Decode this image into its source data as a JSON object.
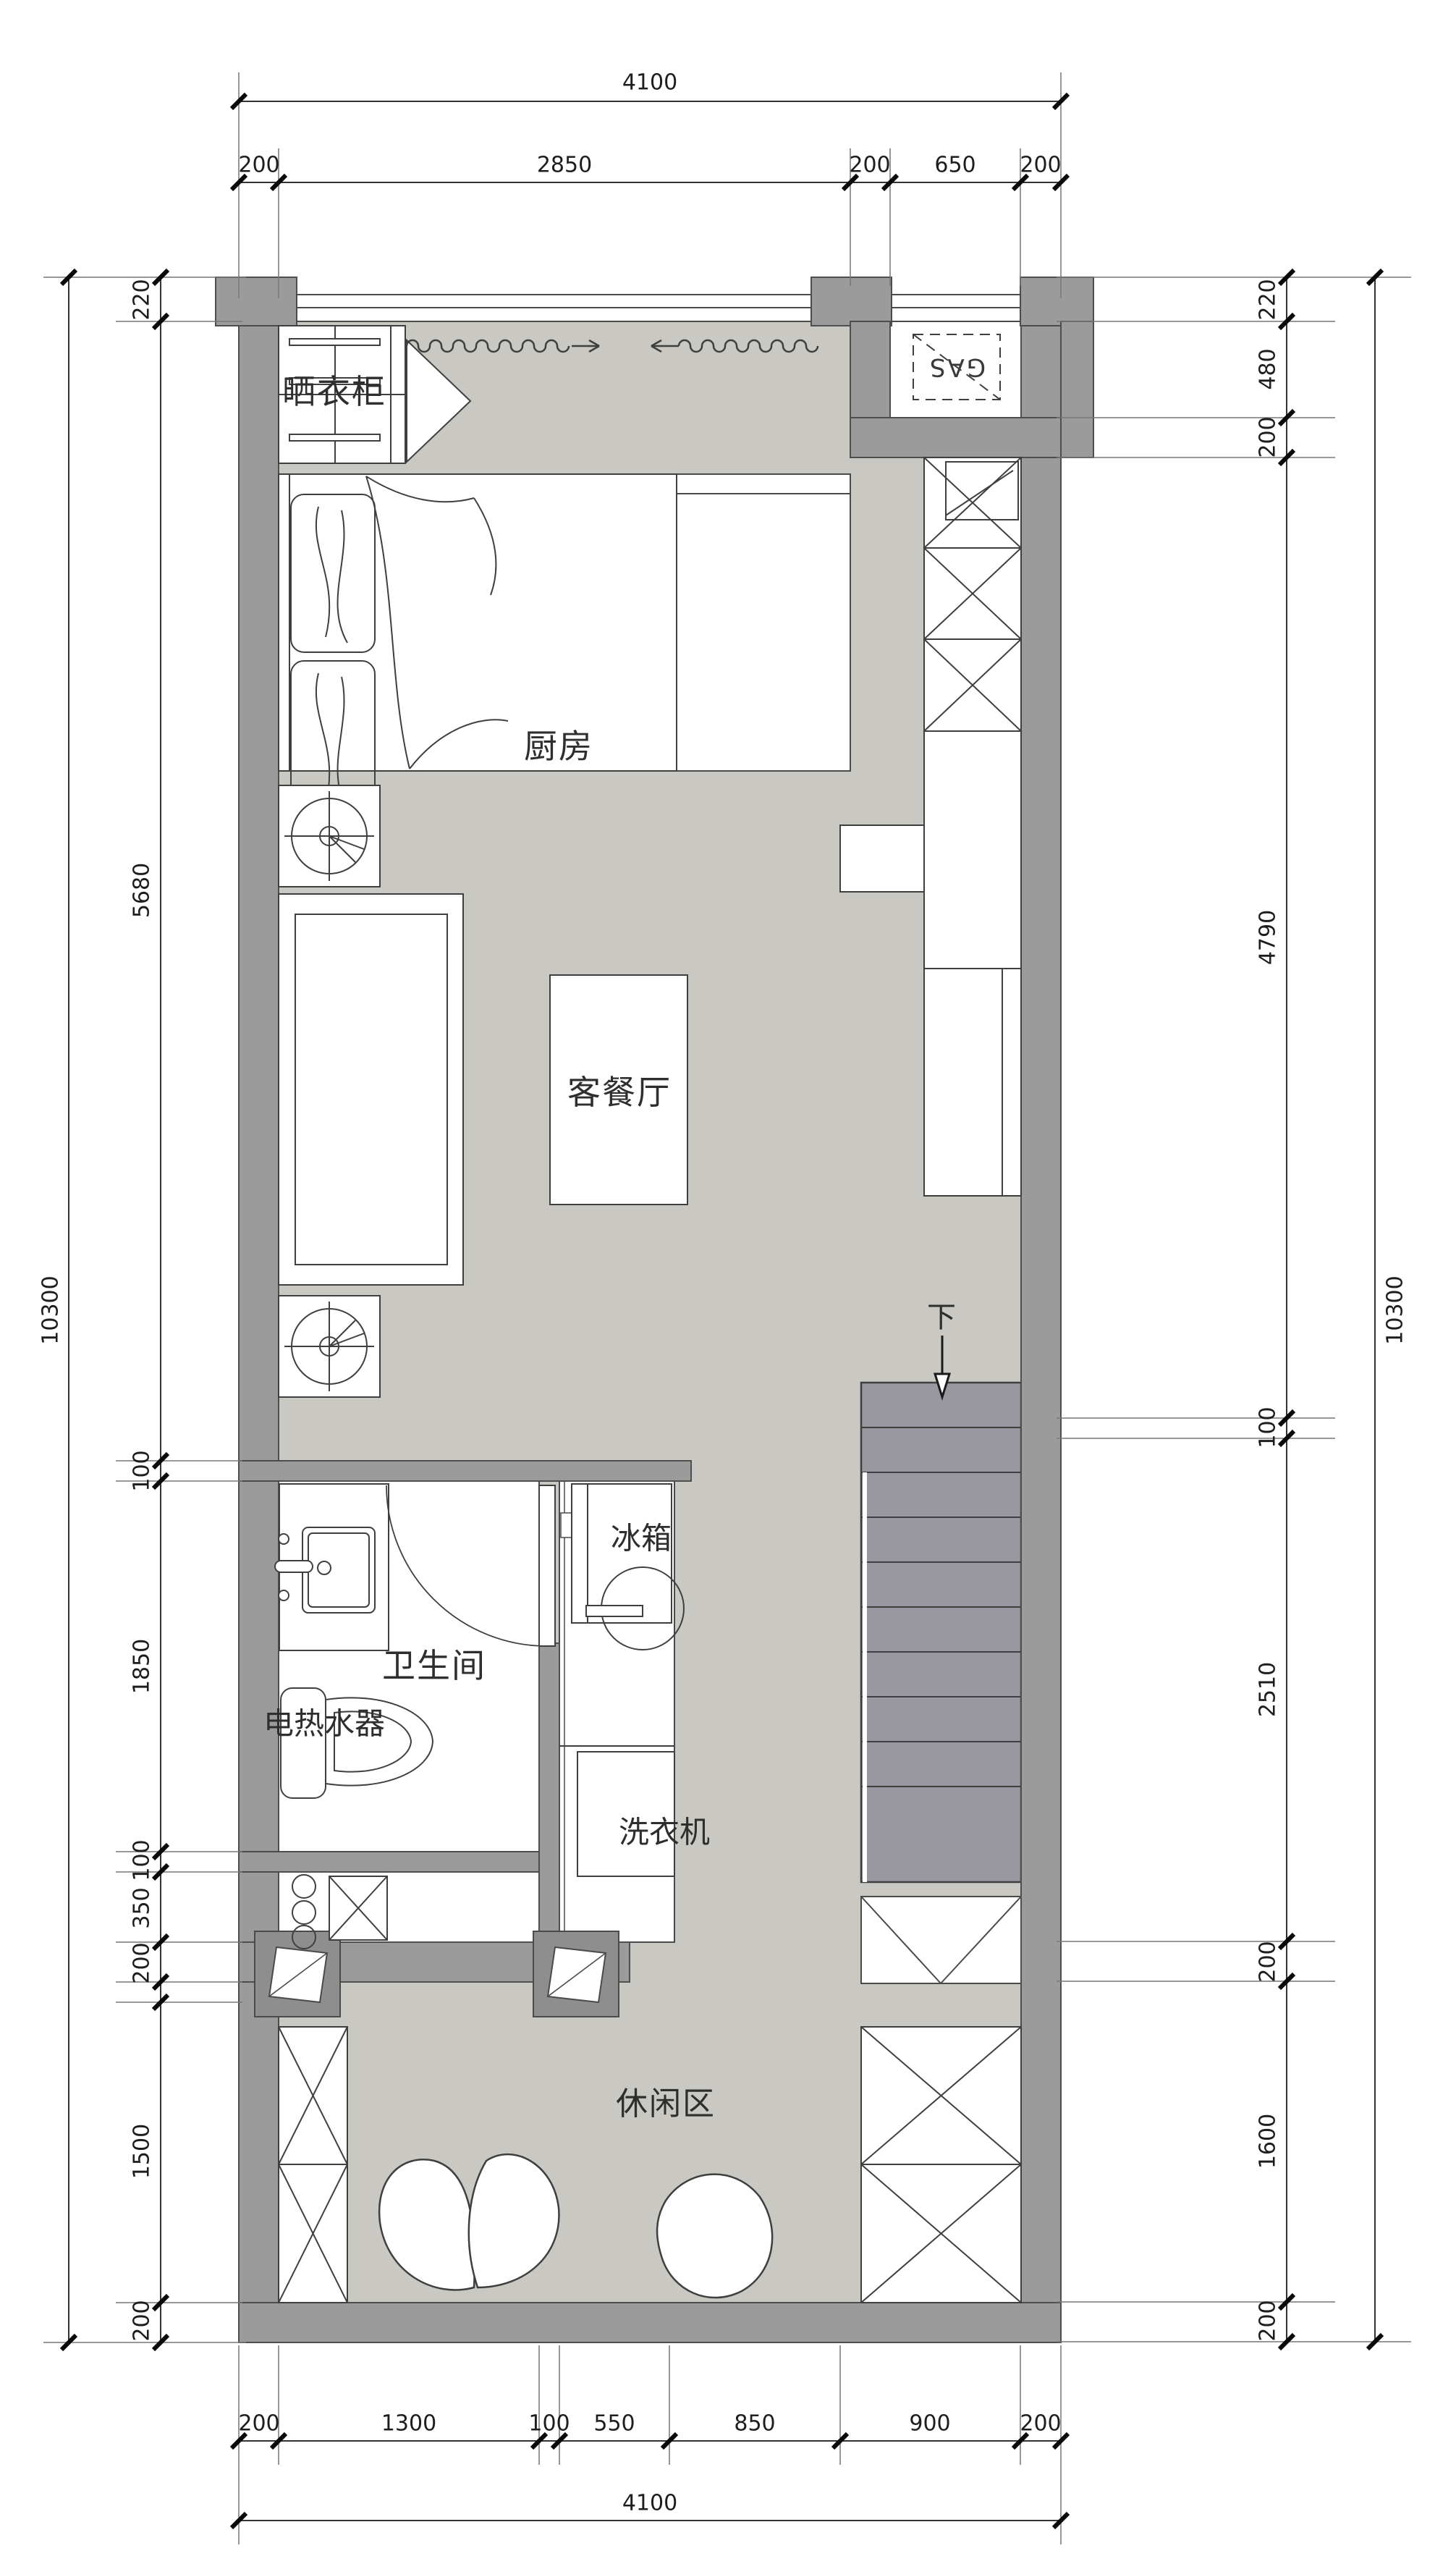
{
  "plan": {
    "rooms": {
      "drying_closet": "晒衣柜",
      "kitchen": "厨房",
      "living_dining": "客餐厅",
      "bathroom": "卫生间",
      "water_heater": "电热水器",
      "fridge": "冰箱",
      "washing_machine": "洗衣机",
      "leisure": "休闲区",
      "stairs_down": "下",
      "gas_meter": "GAS"
    },
    "dimensions": {
      "top_total": "4100",
      "top_chain": [
        "200",
        "2850",
        "200",
        "650",
        "200"
      ],
      "bottom_chain": [
        "200",
        "1300",
        "100",
        "550",
        "850",
        "900",
        "200"
      ],
      "bottom_total": "4100",
      "left_total": "10300",
      "left_chain": [
        "220",
        "5680",
        "100",
        "1850",
        "100",
        "350",
        "200",
        "1500",
        "200"
      ],
      "right_total": "10300",
      "right_chain": [
        "220",
        "480",
        "200",
        "4790",
        "100",
        "2510",
        "200",
        "1600",
        "200"
      ]
    },
    "colors": {
      "floor": "#c9c8c2",
      "wall": "#9c9b9b",
      "stairs": "#99979f",
      "line": "#3f3f3f",
      "background": "#ffffff"
    }
  }
}
